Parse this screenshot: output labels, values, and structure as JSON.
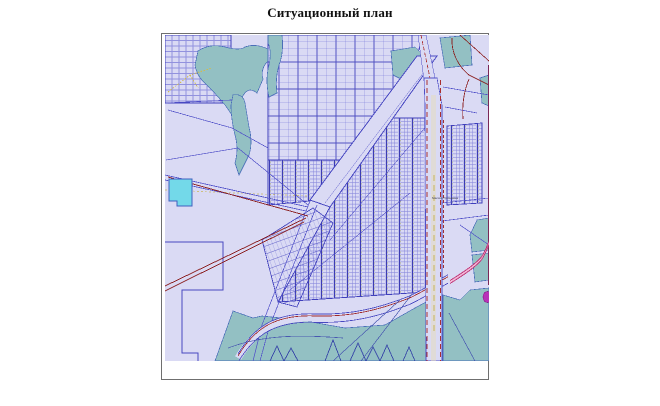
{
  "page": {
    "title": "Ситуационный план"
  },
  "map": {
    "massiv_label": "Массив Грязновка",
    "colors": {
      "map_background": "#dadaf4",
      "parcel_line": "#5f5fd0",
      "block_border": "#4343bd",
      "forest_teal": "#93c0c3",
      "pond_cyan": "#73d9e9",
      "railway_dark_red": "#8b1f1f",
      "highway_red": "#aa3030",
      "road_yellow": "#c9b45c",
      "street_label_olive": "#97972f",
      "pink_road": "#c03878",
      "magenta_marker": "#b832b8",
      "frame_border": "#6f6f6f"
    }
  }
}
